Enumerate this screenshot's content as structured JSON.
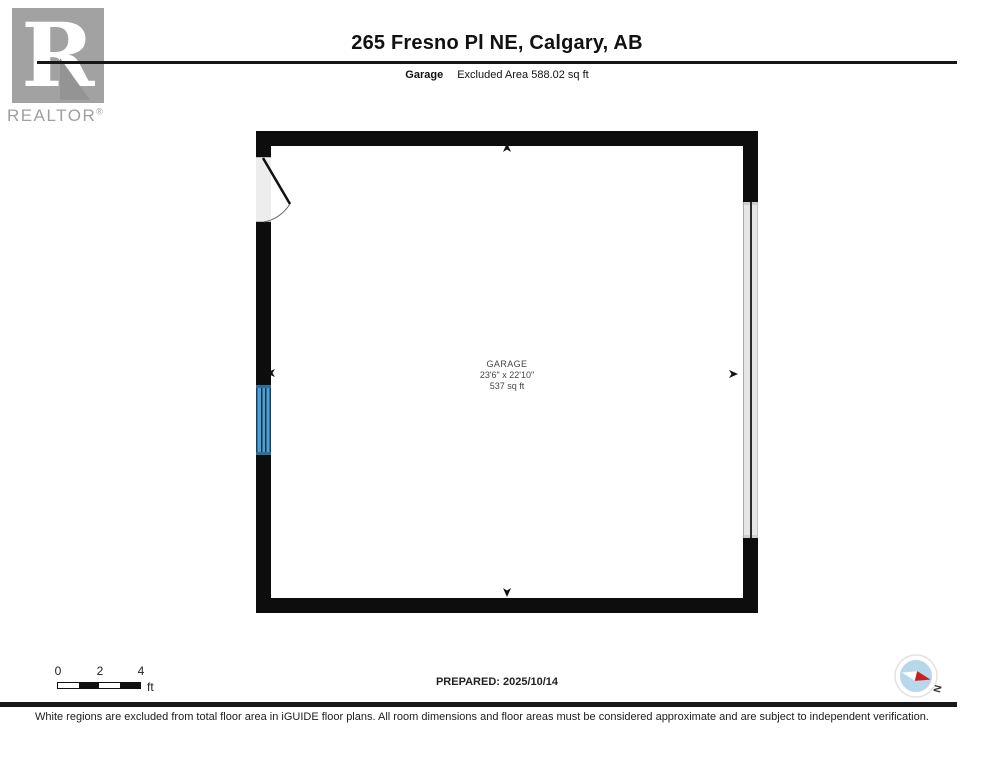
{
  "header": {
    "logo": {
      "letter": "R",
      "brand": "REALTOR",
      "registered": "®"
    },
    "title": "265 Fresno Pl NE, Calgary, AB",
    "floor_label": "Garage",
    "excluded_area": "Excluded Area 588.02 sq ft"
  },
  "floorplan": {
    "room": {
      "name": "GARAGE",
      "dimensions": "23'6\" x 22'10\"",
      "area": "537 sq ft"
    }
  },
  "scale_bar": {
    "ticks": [
      "0",
      "2",
      "4"
    ],
    "unit": "ft"
  },
  "footer": {
    "prepared": "PREPARED: 2025/10/14",
    "compass_label": "N",
    "disclaimer": "White regions are excluded from total floor area in iGUIDE floor plans. All room dimensions and floor areas must be considered approximate and are subject to independent verification."
  },
  "colors": {
    "wall_black": "#0d0d0d",
    "window_blue": "#4f9fd4",
    "door_gray": "#ededed",
    "garage_door_gray": "#e6e6e6",
    "logo_gray": "#a2a2a2",
    "compass_blue": "#b7d7ea",
    "compass_red": "#c62020"
  }
}
